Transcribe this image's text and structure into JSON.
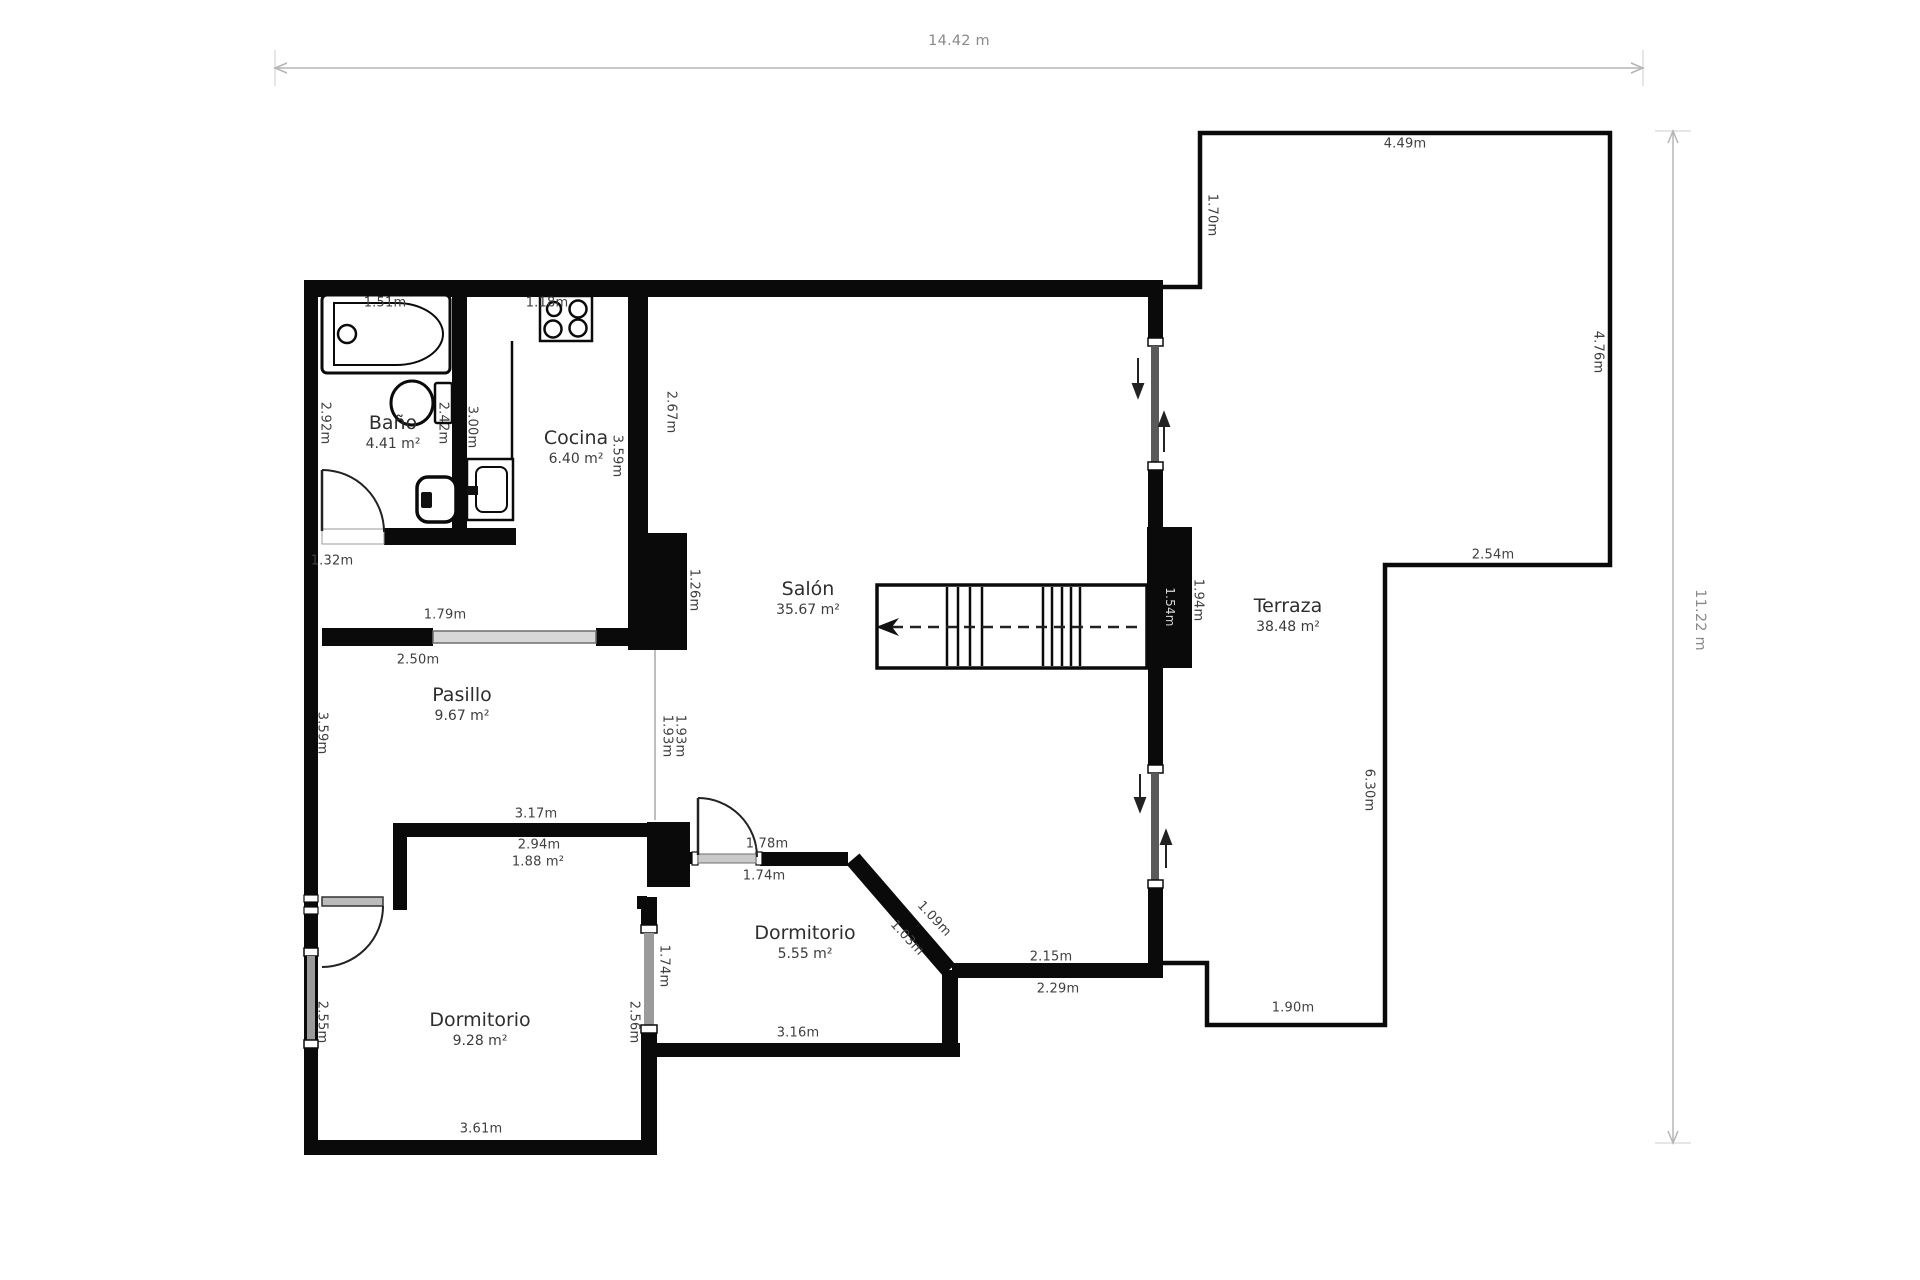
{
  "plan_title": "floor-plan",
  "overall_dimensions": {
    "width_label": "14.42 m",
    "height_label": "11.22 m"
  },
  "rooms": [
    {
      "id": "bano",
      "name": "Baño",
      "area": "4.41 m²",
      "x": 393,
      "y": 432
    },
    {
      "id": "cocina",
      "name": "Cocina",
      "area": "6.40 m²",
      "x": 576,
      "y": 447
    },
    {
      "id": "salon",
      "name": "Salón",
      "area": "35.67 m²",
      "x": 808,
      "y": 598
    },
    {
      "id": "pasillo",
      "name": "Pasillo",
      "area": "9.67 m²",
      "x": 462,
      "y": 704
    },
    {
      "id": "terraza",
      "name": "Terraza",
      "area": "38.48 m²",
      "x": 1288,
      "y": 615
    },
    {
      "id": "dormitorio-2",
      "name": "Dormitorio",
      "area": "5.55 m²",
      "x": 805,
      "y": 942
    },
    {
      "id": "dormitorio-1",
      "name": "Dormitorio",
      "area": "9.28 m²",
      "x": 480,
      "y": 1029
    }
  ],
  "measurements": [
    {
      "t": "14.42 m",
      "x": 959,
      "y": 41,
      "r": 0,
      "c": "#8a8a8a",
      "s": 14.5,
      "n": "dim-total-width"
    },
    {
      "t": "11.22 m",
      "x": 1700,
      "y": 620,
      "r": 90,
      "c": "#8a8a8a",
      "s": 14.5,
      "n": "dim-total-height"
    },
    {
      "t": "1.51m",
      "x": 385,
      "y": 303,
      "r": 0
    },
    {
      "t": "1.18m",
      "x": 547,
      "y": 303,
      "r": 0
    },
    {
      "t": "2.92m",
      "x": 325,
      "y": 423,
      "r": 90
    },
    {
      "t": "2.42m",
      "x": 443,
      "y": 423,
      "r": 90
    },
    {
      "t": "3.00m",
      "x": 472,
      "y": 427,
      "r": 90
    },
    {
      "t": "3.59m",
      "x": 617,
      "y": 456,
      "r": 90
    },
    {
      "t": "2.67m",
      "x": 671,
      "y": 412,
      "r": 90
    },
    {
      "t": "1.26m",
      "x": 694,
      "y": 590,
      "r": 90
    },
    {
      "t": "1.32m",
      "x": 332,
      "y": 561,
      "r": 0
    },
    {
      "t": "1.79m",
      "x": 445,
      "y": 615,
      "r": 0
    },
    {
      "t": "2.50m",
      "x": 418,
      "y": 660,
      "r": 0
    },
    {
      "t": "3.59m",
      "x": 322,
      "y": 733,
      "r": 90
    },
    {
      "t": "1.93m",
      "x": 667,
      "y": 736,
      "r": 90
    },
    {
      "t": "1.93m",
      "x": 680,
      "y": 736,
      "r": 90
    },
    {
      "t": "3.17m",
      "x": 536,
      "y": 814,
      "r": 0
    },
    {
      "t": "2.94m",
      "x": 539,
      "y": 845,
      "r": 0
    },
    {
      "t": "1.88 m²",
      "x": 538,
      "y": 862,
      "r": 0
    },
    {
      "t": "1.78m",
      "x": 767,
      "y": 844,
      "r": 0
    },
    {
      "t": "1.74m",
      "x": 764,
      "y": 876,
      "r": 0
    },
    {
      "t": "1.09m",
      "x": 934,
      "y": 919,
      "r": 47
    },
    {
      "t": "1.03m",
      "x": 907,
      "y": 938,
      "r": 47
    },
    {
      "t": "2.15m",
      "x": 1051,
      "y": 957,
      "r": 0
    },
    {
      "t": "2.29m",
      "x": 1058,
      "y": 989,
      "r": 0
    },
    {
      "t": "3.16m",
      "x": 798,
      "y": 1033,
      "r": 0
    },
    {
      "t": "1.74m",
      "x": 664,
      "y": 966,
      "r": 90
    },
    {
      "t": "2.56m",
      "x": 634,
      "y": 1022,
      "r": 90
    },
    {
      "t": "2.55m",
      "x": 322,
      "y": 1022,
      "r": 90
    },
    {
      "t": "3.61m",
      "x": 481,
      "y": 1129,
      "r": 0
    },
    {
      "t": "1.94m",
      "x": 1198,
      "y": 600,
      "r": 90
    },
    {
      "t": "1.54m",
      "x": 1170,
      "y": 607,
      "r": 90,
      "c": "#d6d6d6",
      "s": 12
    },
    {
      "t": "4.49m",
      "x": 1405,
      "y": 144,
      "r": 0
    },
    {
      "t": "1.70m",
      "x": 1212,
      "y": 215,
      "r": 90
    },
    {
      "t": "4.76m",
      "x": 1598,
      "y": 352,
      "r": 90
    },
    {
      "t": "2.54m",
      "x": 1493,
      "y": 555,
      "r": 0
    },
    {
      "t": "6.30m",
      "x": 1369,
      "y": 790,
      "r": 90
    },
    {
      "t": "1.90m",
      "x": 1293,
      "y": 1008,
      "r": 0
    }
  ],
  "icons": [
    "bathtub-icon",
    "toilet-icon",
    "bidet-icon",
    "kitchen-sink-icon",
    "stove-icon",
    "staircase-icon",
    "door-swing-icon",
    "sliding-door-icon",
    "direction-arrow-icon"
  ],
  "colors": {
    "wall": "#0a0a0a",
    "measurement_text": "#3f3f3f",
    "dimension_line": "#b5b5b5",
    "window_glass": "#c9c9c9"
  }
}
